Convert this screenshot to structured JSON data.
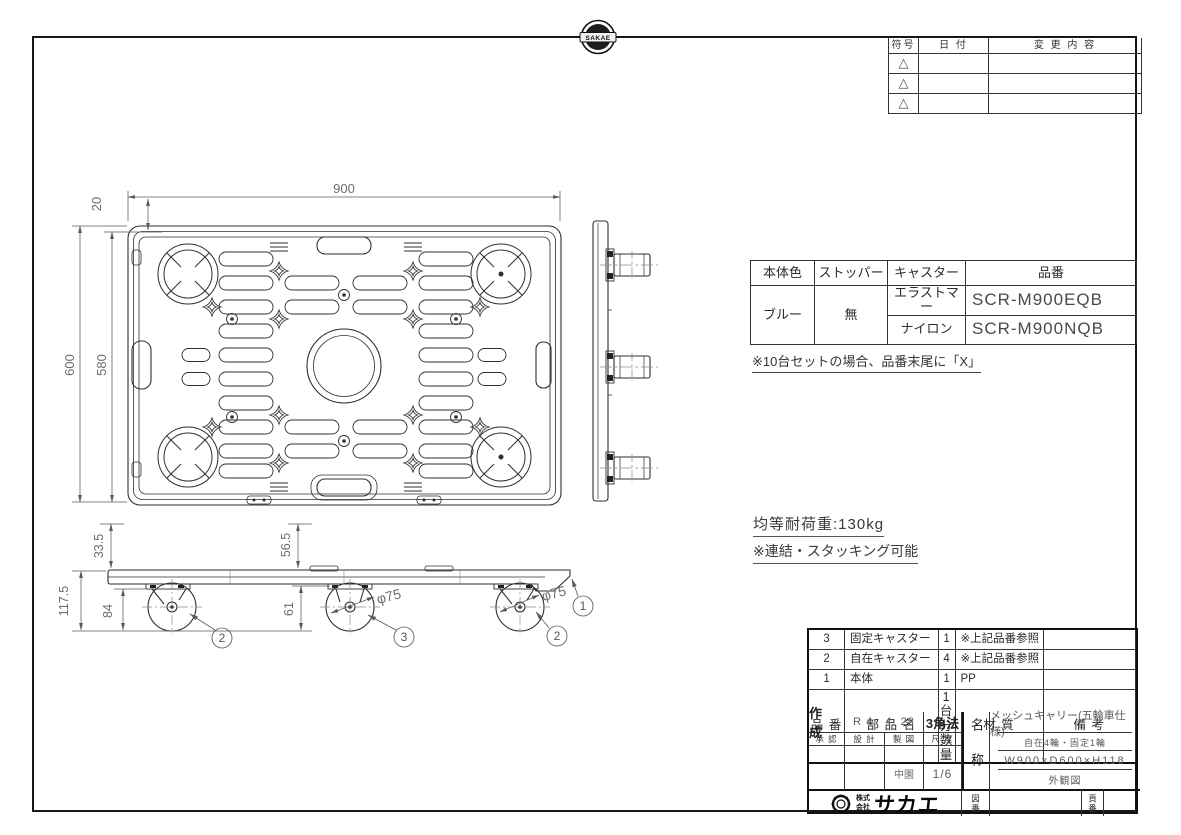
{
  "sheet": {
    "logo_top": "SAKAE"
  },
  "revision": {
    "col_symbol": "符号",
    "col_date": "日 付",
    "col_desc": "変 更 内 容",
    "rows": [
      "△",
      "△",
      "△"
    ]
  },
  "product_table": {
    "h_body_color": "本体色",
    "h_stopper": "ストッパー",
    "h_caster": "キャスター",
    "h_code": "品番",
    "body_color": "ブルー",
    "stopper": "無",
    "rows": [
      {
        "caster": "エラストマー",
        "code": "SCR-M900EQB"
      },
      {
        "caster": "ナイロン",
        "code": "SCR-M900NQB"
      }
    ],
    "note": "※10台セットの場合、品番末尾に「X」"
  },
  "notes": {
    "load": "均等耐荷重:130kg",
    "stacking": "※連結・スタッキング可能"
  },
  "dims": {
    "top_width": "900",
    "top_offset": "20",
    "depth": "600",
    "depth_inner": "580",
    "h_total": "117.5",
    "h_upper": "33.5",
    "h_under": "84",
    "h_mid": "56.5",
    "h_axle": "61",
    "dia_center": "φ75",
    "dia_right": "φ75"
  },
  "balloons": {
    "body": "1",
    "swivel_left": "2",
    "fixed": "3",
    "swivel_right": "2"
  },
  "parts_list": {
    "h_no": "品 番",
    "h_name": "部 品 名",
    "h_qty1": "1台分",
    "h_qty2": "数 量",
    "h_material": "材 質",
    "h_remarks": "備 考",
    "rows": [
      {
        "no": "3",
        "name": "固定キャスター",
        "qty": "1",
        "material": "※上記品番参照",
        "remarks": ""
      },
      {
        "no": "2",
        "name": "自在キャスター",
        "qty": "4",
        "material": "※上記品番参照",
        "remarks": ""
      },
      {
        "no": "1",
        "name": "本体",
        "qty": "1",
        "material": "PP",
        "remarks": ""
      }
    ]
  },
  "title_block": {
    "created_label": "作 成",
    "created_date": "R 4.  4. 28",
    "projection": "3角法",
    "h_approved": "承 認",
    "h_design": "設 計",
    "h_draft": "製 図",
    "h_scale": "尺 度",
    "drafter": "中園",
    "scale": "1/6",
    "name_label": "名称",
    "product_name": "メッシュキャリー(五輪車仕様)",
    "spec": "自在4輪・固定1輪",
    "size": "W900×D600×H118",
    "view_type": "外観図",
    "company_prefix_1": "株式",
    "company_prefix_2": "会社",
    "company_name": "サカエ",
    "drawing_no_label": "図番",
    "page_no_label": "頁番"
  }
}
